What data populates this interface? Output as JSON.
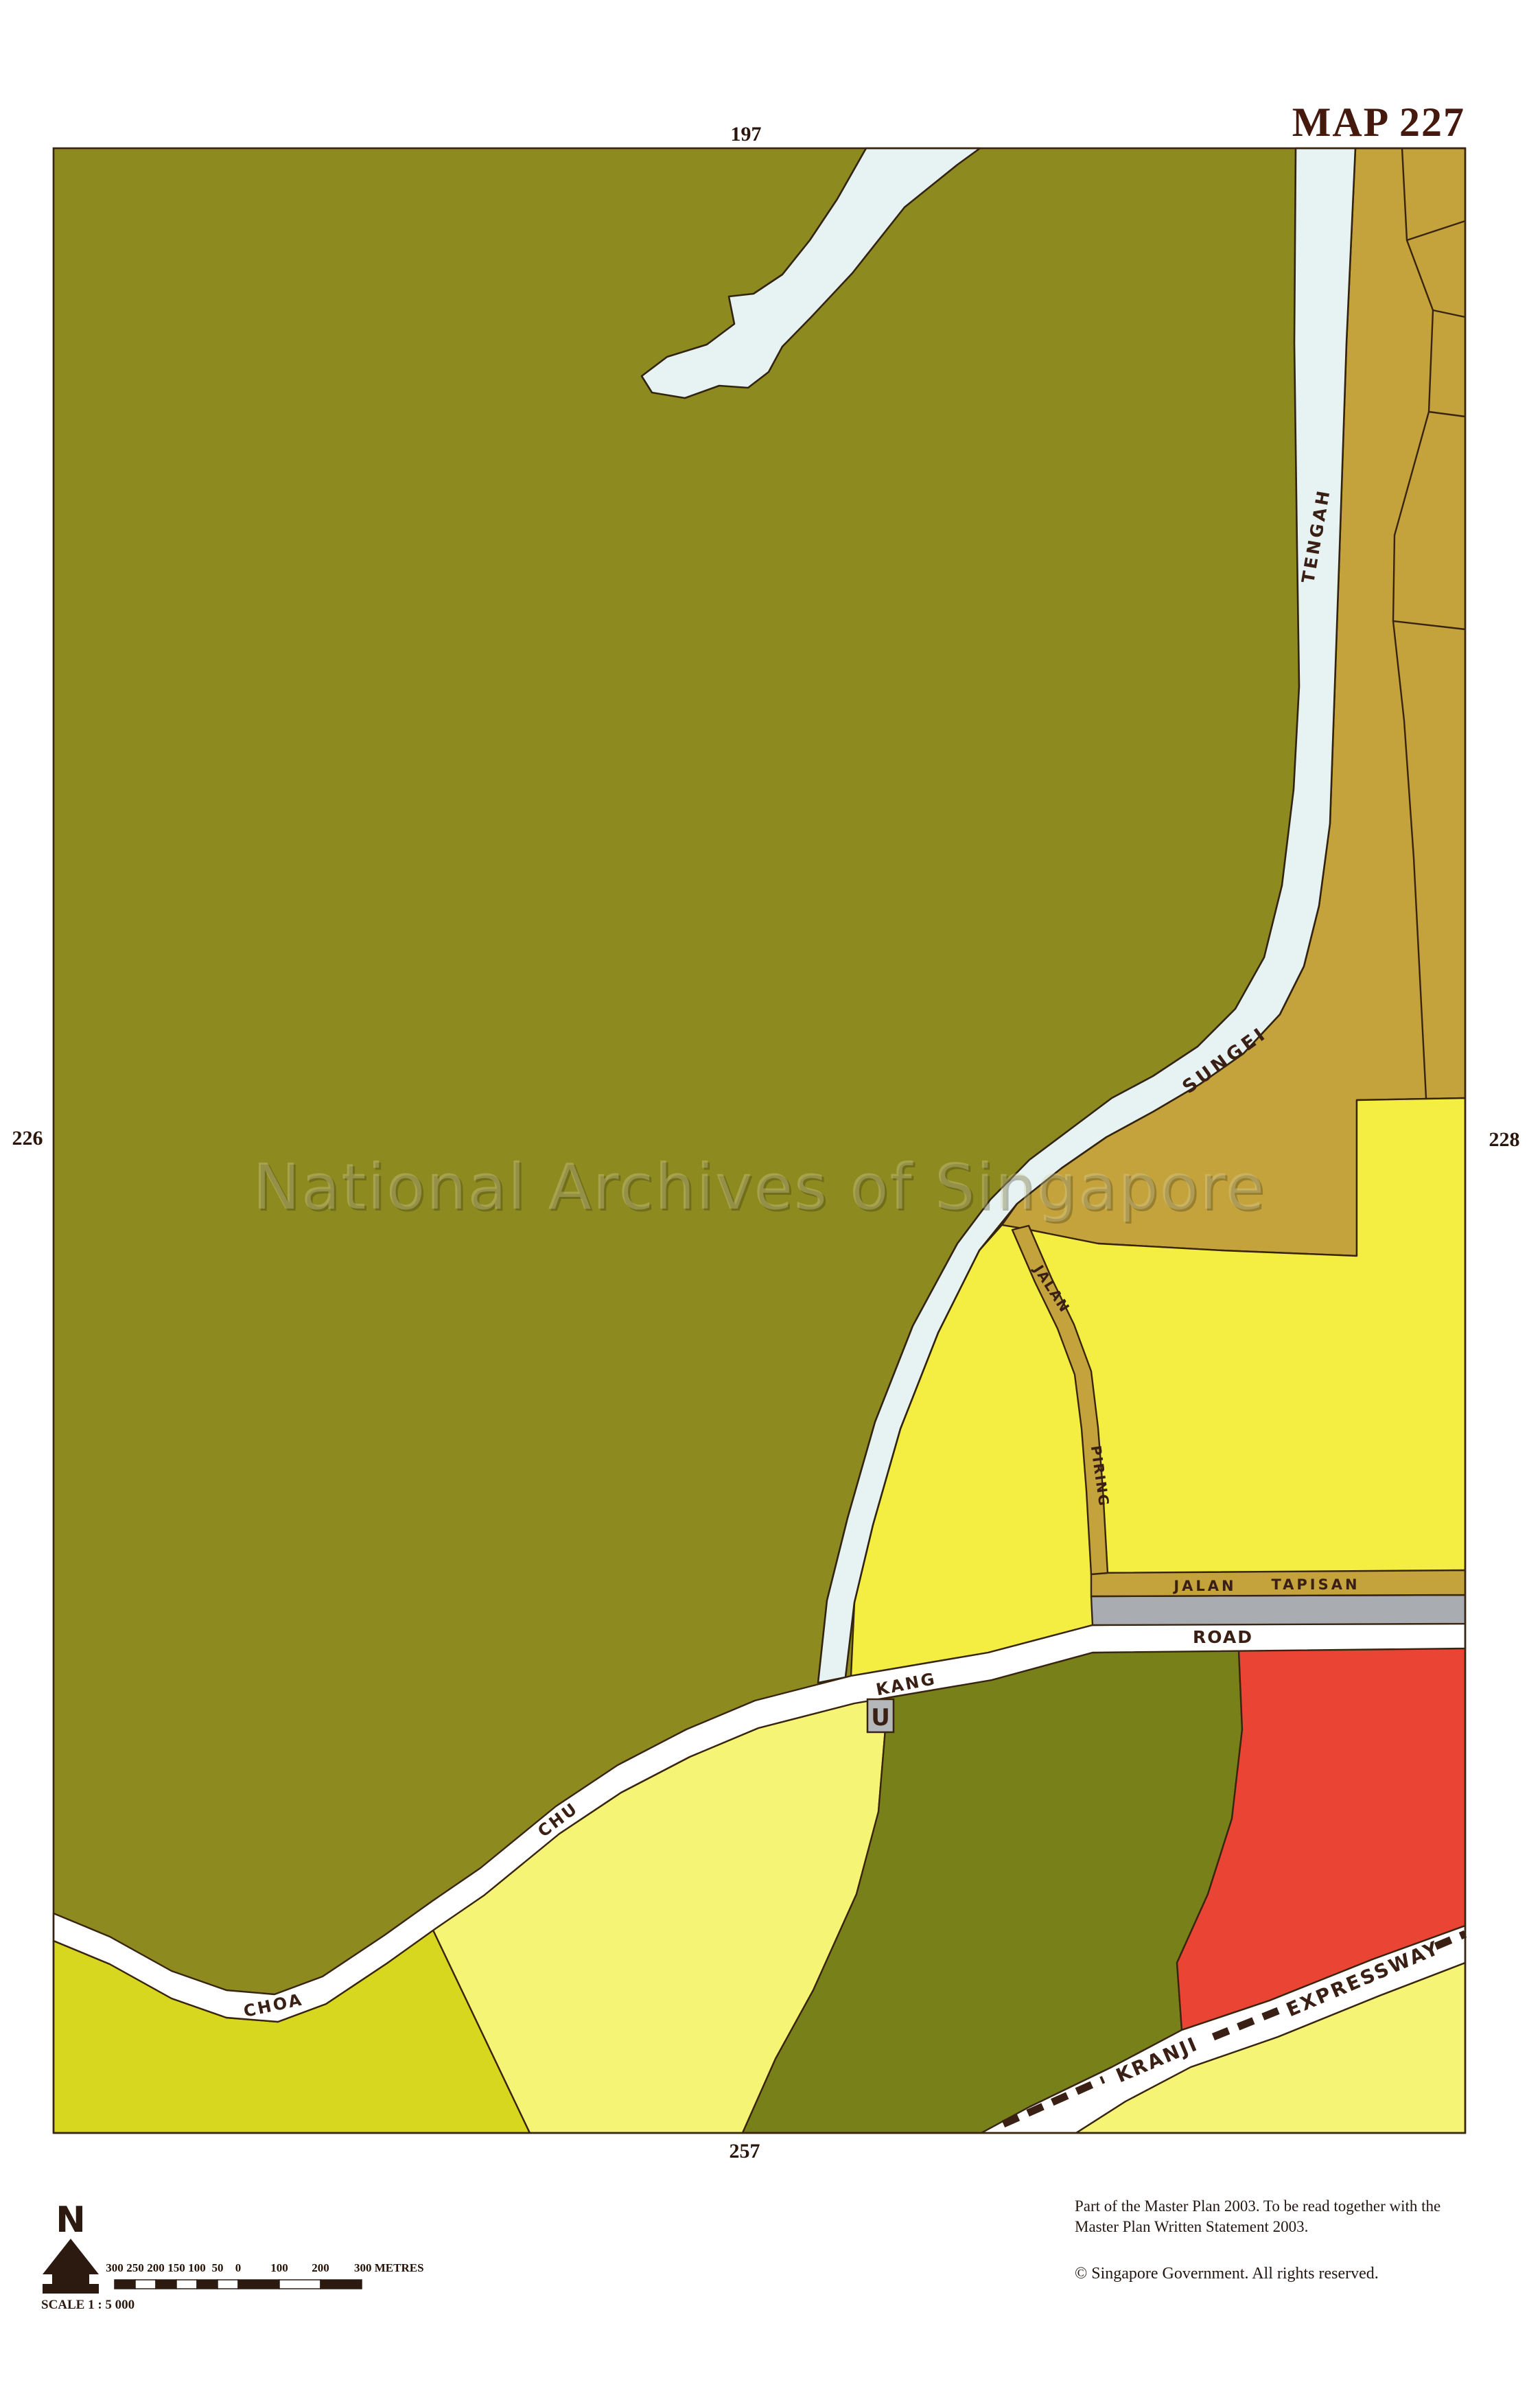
{
  "page": {
    "title": "MAP 227"
  },
  "map": {
    "adjacent_sheets": {
      "top": "197",
      "left": "226",
      "right": "228",
      "bottom": "257"
    },
    "labels": {
      "river_1": "SUNGEI",
      "river_2": "TENGAH",
      "road_choa": "CHOA",
      "road_chu": "CHU",
      "road_kang": "KANG",
      "road_road": "ROAD",
      "jalan_tapisan_1": "JALAN",
      "jalan_tapisan_2": "TAPISAN",
      "jalan_piring_1": "JALAN",
      "jalan_piring_2": "PIRING",
      "expressway_1": "KRANJI",
      "expressway_2": "EXPRESSWAY",
      "underpass": "U"
    },
    "watermark": "National Archives of Singapore",
    "legend": {
      "north_letter": "N",
      "scale_text": "SCALE 1 : 5 000",
      "scale_ticks": [
        "300",
        "250",
        "200",
        "150",
        "100",
        "50",
        "0",
        "100",
        "200",
        "300 METRES"
      ]
    },
    "notes": {
      "line1": "Part of the Master Plan 2003.  To be read together  with  the",
      "line2": "Master Plan Written Statement 2003.",
      "copyright": "©  Singapore Government.  All rights reserved."
    },
    "colors": {
      "olive": "#8d8a1f",
      "olive_dark": "#78801a",
      "tan": "#c4a23c",
      "yellow_bright": "#f3ee41",
      "yellow_pale": "#f6f475",
      "chartreuse": "#d7d71f",
      "red": "#e94434",
      "gray_reserve": "#a9acb0",
      "water": "#e6f3f2",
      "road_white": "#ffffff",
      "line": "#38240f",
      "label": "#3a2014",
      "title": "#46190e",
      "ubox": "#b4b8ba"
    }
  }
}
